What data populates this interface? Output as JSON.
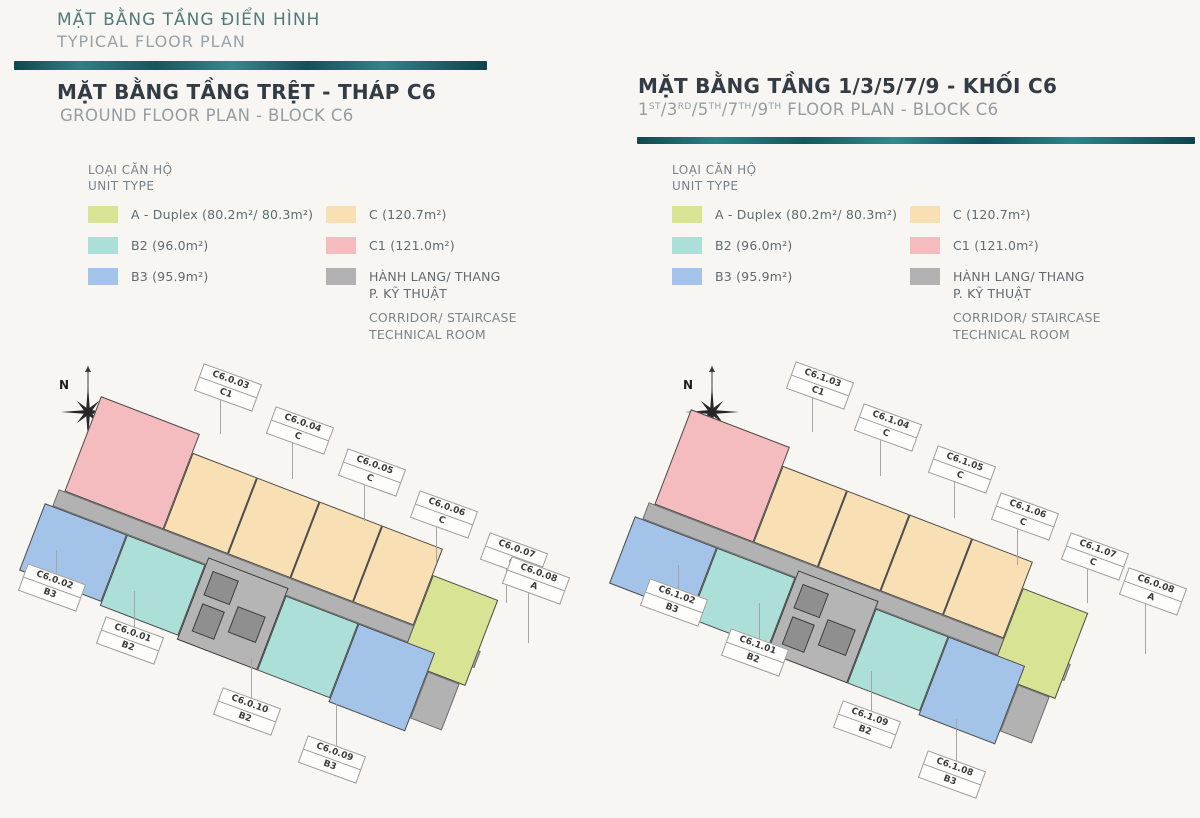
{
  "header": {
    "title_vi": "MẶT BẰNG TẦNG ĐIỂN HÌNH",
    "title_en": "TYPICAL FLOOR PLAN"
  },
  "palette": {
    "A": "#d8e394",
    "B2": "#abdfd8",
    "B3": "#a3c4e8",
    "C": "#f8dfb4",
    "C1": "#f4bcbe",
    "corridor": "#b2b2b2",
    "core": "#b5b5b5",
    "accent_dark": "#11474d",
    "accent_light": "#2e8589"
  },
  "legend": {
    "title_vi": "LOẠI CĂN HỘ",
    "title_en": "UNIT TYPE",
    "col1": [
      {
        "label": "A - Duplex (80.2m²/ 80.3m²)",
        "color_key": "A"
      },
      {
        "label": "B2 (96.0m²)",
        "color_key": "B2"
      },
      {
        "label": "B3 (95.9m²)",
        "color_key": "B3"
      }
    ],
    "col2": [
      {
        "label": "C (120.7m²)",
        "color_key": "C"
      },
      {
        "label": "C1 (121.0m²)",
        "color_key": "C1"
      },
      {
        "lines_vi": [
          "HÀNH LANG/ THANG",
          "P. KỸ THUẬT"
        ],
        "lines_en": [
          "CORRIDOR/ STAIRCASE",
          "TECHNICAL ROOM"
        ],
        "color_key": "corridor"
      }
    ]
  },
  "compass": {
    "label": "N"
  },
  "plans": [
    {
      "title_vi": "MẶT BẰNG TẦNG TRỆT - THÁP C6",
      "title_en": "GROUND FLOOR PLAN - BLOCK C6",
      "labels": [
        {
          "code": "C6.0.03",
          "type": "C1",
          "x": 228,
          "y": 388,
          "dir": "down",
          "len": 34
        },
        {
          "code": "C6.0.04",
          "type": "C",
          "x": 300,
          "y": 431,
          "dir": "down",
          "len": 36
        },
        {
          "code": "C6.0.05",
          "type": "C",
          "x": 372,
          "y": 473,
          "dir": "down",
          "len": 36
        },
        {
          "code": "C6.0.06",
          "type": "C",
          "x": 444,
          "y": 515,
          "dir": "down",
          "len": 36
        },
        {
          "code": "C6.0.07",
          "type": "C",
          "x": 514,
          "y": 557,
          "dir": "down",
          "len": 34
        },
        {
          "code": "C6.0.08",
          "type": "A",
          "x": 536,
          "y": 581,
          "dir": "down",
          "len": 50
        },
        {
          "code": "C6.0.02",
          "type": "B3",
          "x": 52,
          "y": 588,
          "dir": "up",
          "len": 26
        },
        {
          "code": "C6.0.01",
          "type": "B2",
          "x": 130,
          "y": 641,
          "dir": "up",
          "len": 38
        },
        {
          "code": "C6.0.10",
          "type": "B2",
          "x": 247,
          "y": 712,
          "dir": "up",
          "len": 42
        },
        {
          "code": "C6.0.09",
          "type": "B3",
          "x": 332,
          "y": 760,
          "dir": "up",
          "len": 44
        }
      ]
    },
    {
      "title_vi": "MẶT BẰNG TẦNG 1/3/5/7/9 - KHỐI C6",
      "title_en_segments": [
        [
          "1",
          "ST"
        ],
        [
          "/3",
          "RD"
        ],
        [
          "/5",
          "TH"
        ],
        [
          "/7",
          "TH"
        ],
        [
          "/9",
          "TH"
        ],
        [
          " FLOOR PLAN - BLOCK C6",
          ""
        ]
      ],
      "labels": [
        {
          "code": "C6.1.03",
          "type": "C1",
          "x": 820,
          "y": 386,
          "dir": "down",
          "len": 34
        },
        {
          "code": "C6.1.04",
          "type": "C",
          "x": 888,
          "y": 428,
          "dir": "down",
          "len": 36
        },
        {
          "code": "C6.1.05",
          "type": "C",
          "x": 962,
          "y": 470,
          "dir": "down",
          "len": 36
        },
        {
          "code": "C6.1.06",
          "type": "C",
          "x": 1025,
          "y": 517,
          "dir": "down",
          "len": 36
        },
        {
          "code": "C6.1.07",
          "type": "C",
          "x": 1095,
          "y": 557,
          "dir": "down",
          "len": 34
        },
        {
          "code": "C6.0.08",
          "type": "A",
          "x": 1153,
          "y": 592,
          "dir": "down",
          "len": 50
        },
        {
          "code": "C6.1.02",
          "type": "B3",
          "x": 674,
          "y": 603,
          "dir": "up",
          "len": 26
        },
        {
          "code": "C6.1.01",
          "type": "B2",
          "x": 755,
          "y": 653,
          "dir": "up",
          "len": 38
        },
        {
          "code": "C6.1.09",
          "type": "B2",
          "x": 867,
          "y": 725,
          "dir": "up",
          "len": 42
        },
        {
          "code": "C6.1.08",
          "type": "B3",
          "x": 952,
          "y": 775,
          "dir": "up",
          "len": 44
        }
      ]
    }
  ]
}
